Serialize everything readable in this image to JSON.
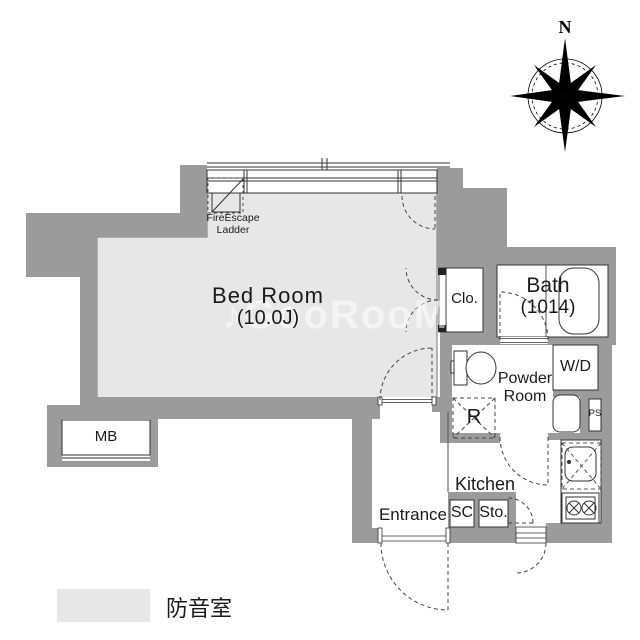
{
  "colors": {
    "wall": "#9b9b9b",
    "soundproof_floor": "#e7e7e7",
    "line": "#333333"
  },
  "compass": {
    "north_label": "N"
  },
  "labels": {
    "bedroom": {
      "name": "Bed Room",
      "size": "(10.0J)"
    },
    "bath": {
      "name": "Bath",
      "size": "(1014)"
    },
    "powder_room": {
      "line1": "Powder",
      "line2": "Room"
    },
    "closet": "Clo.",
    "washer_dryer": "W/D",
    "pipe_space": "PS",
    "refrigerator": "R",
    "kitchen": "Kitchen",
    "entrance": "Entrance",
    "shoe_closet": "SC",
    "storage": "Sto.",
    "meter_box": "MB",
    "fire_escape": {
      "line1": "FireEscape",
      "line2": "Ladder"
    }
  },
  "legend": {
    "label": "防音室",
    "swatch_color": "#e7e7e7"
  },
  "watermark": "♪GooRooM"
}
